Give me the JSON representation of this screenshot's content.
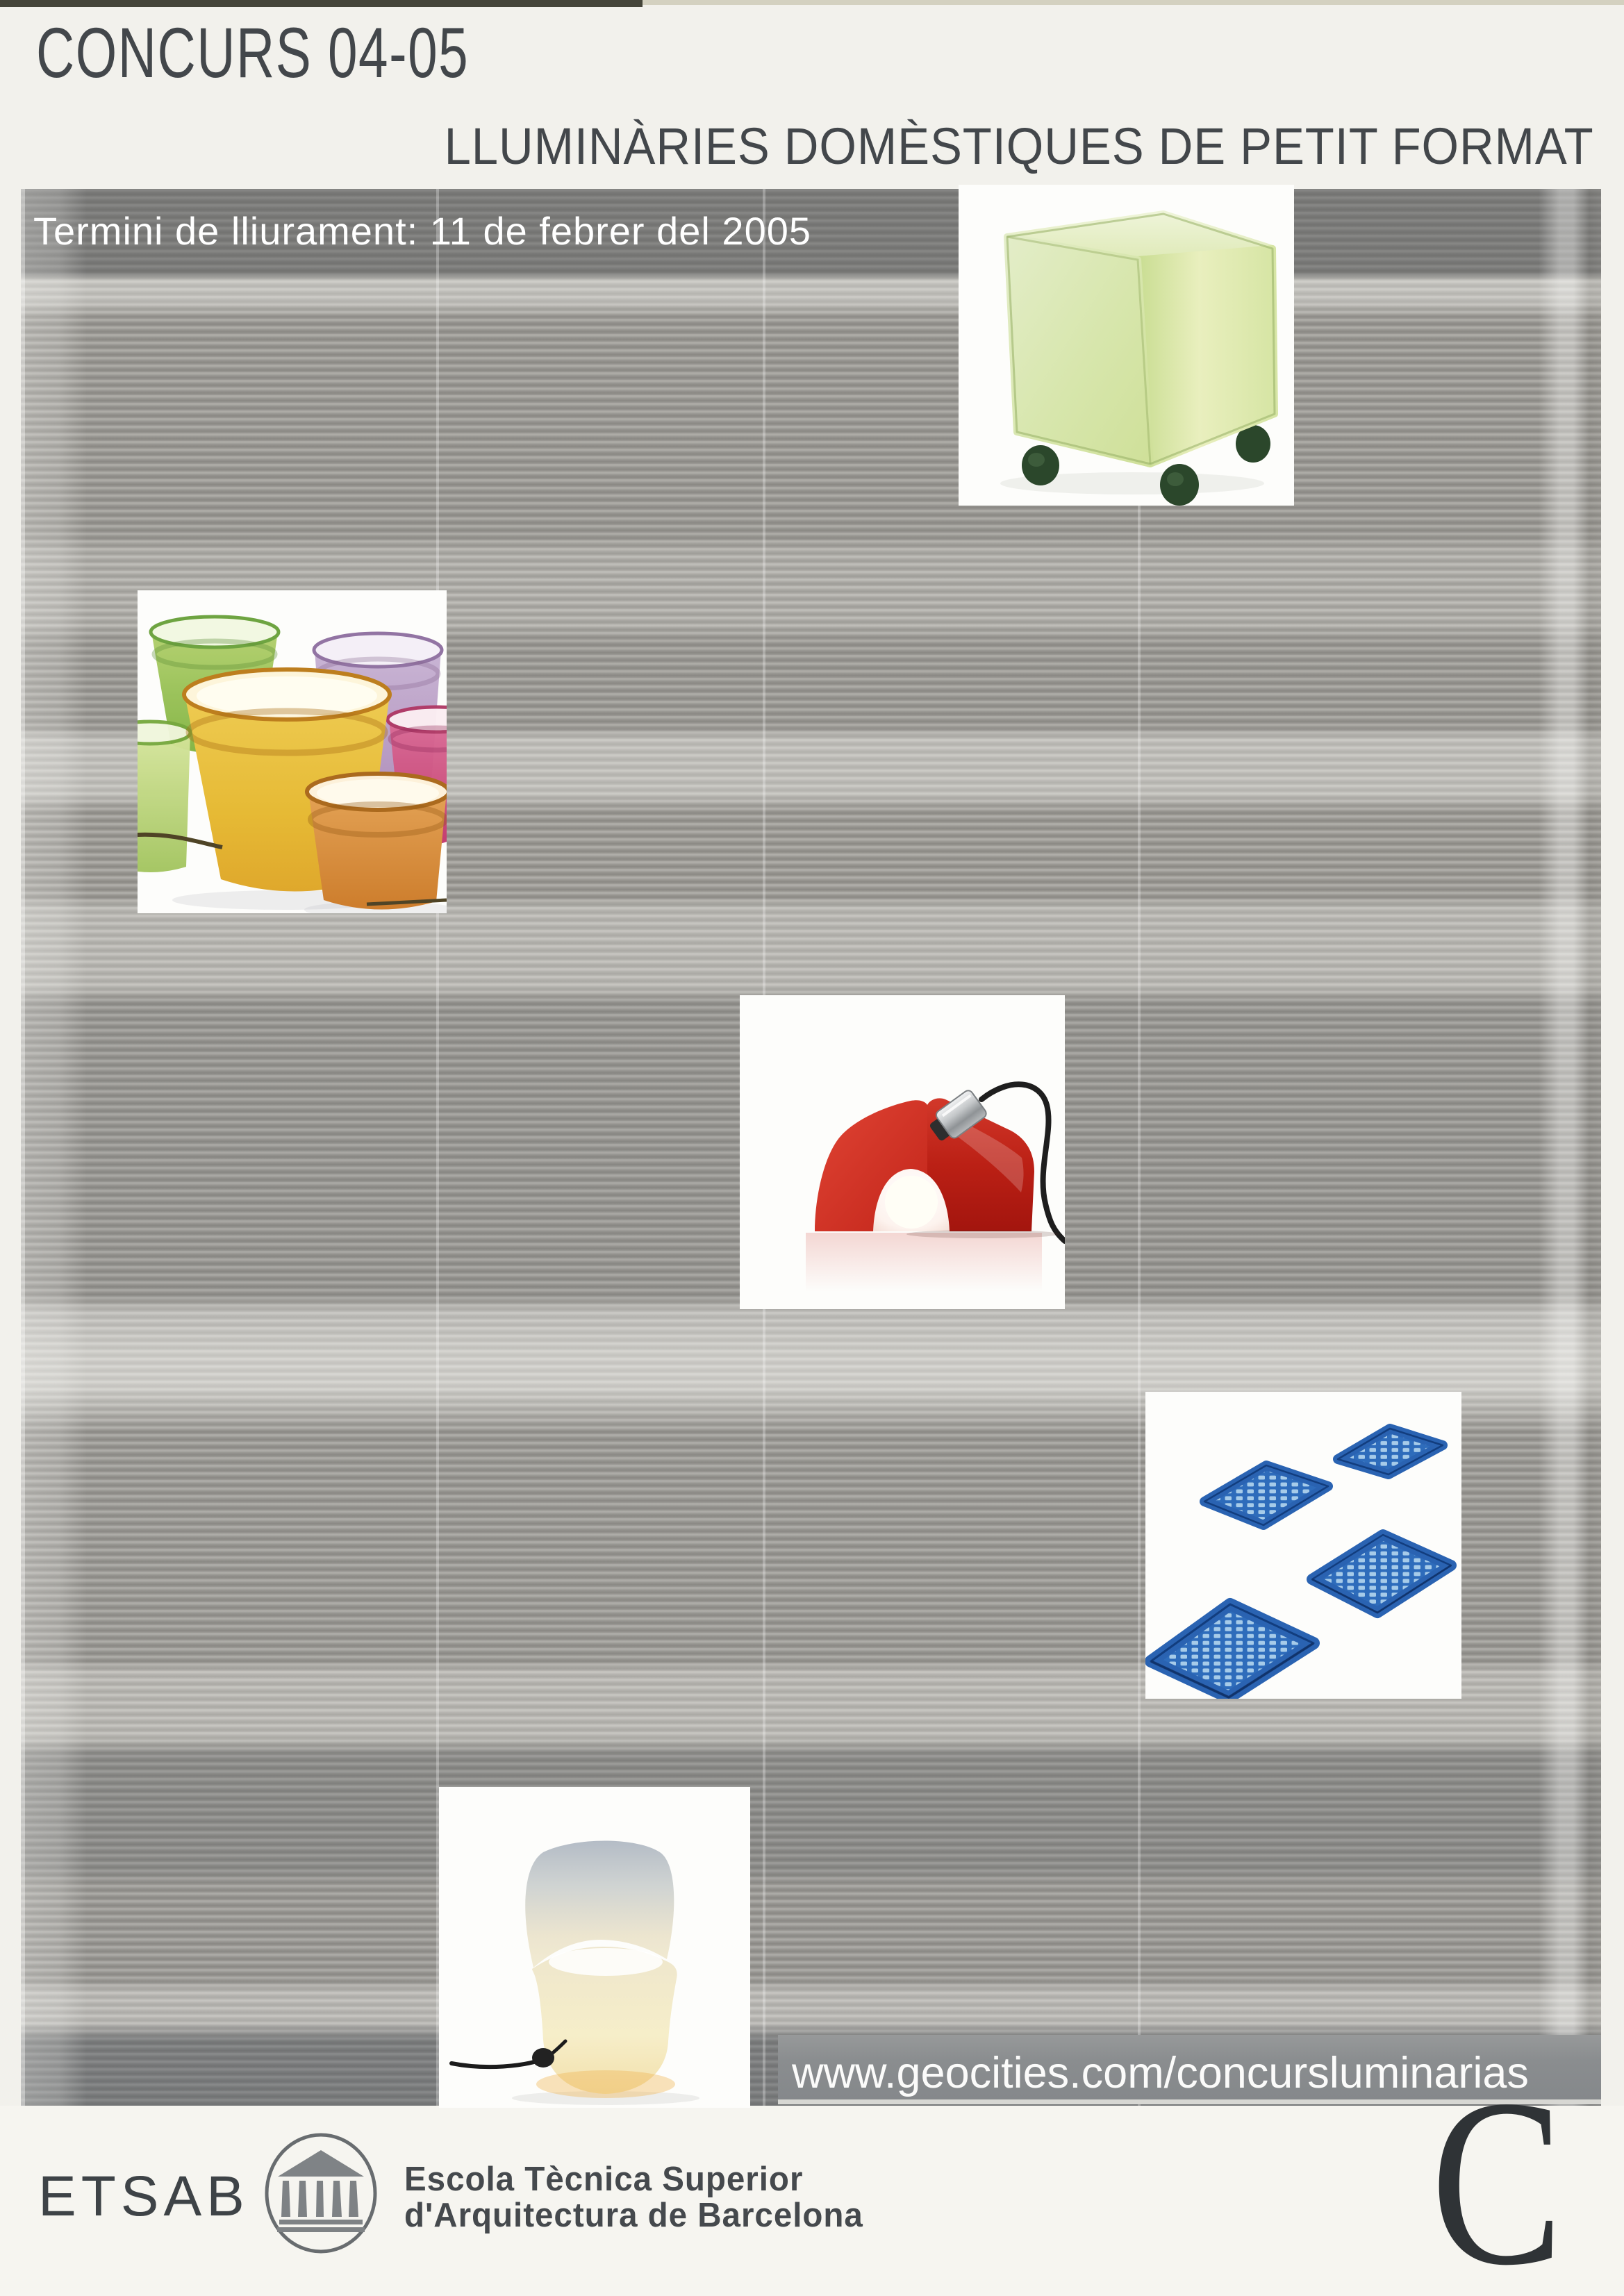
{
  "header": {
    "title": "CONCURS 04-05",
    "subtitle": "LLUMINÀRIES DOMÈSTIQUES DE PETIT FORMAT",
    "deadline": "Termini de lliurament: 11 de febrer del 2005"
  },
  "link": {
    "url": "www.geocities.com/concursluminarias"
  },
  "footer": {
    "school_acronym": "ETSAB",
    "school_name_line1": "Escola Tècnica Superior",
    "school_name_line2": "d'Arquitectura de Barcelona",
    "corner_letter": "C"
  },
  "images": {
    "cube_lamp": "green-cube-lamp-on-casters",
    "pot_lamps": "colored-flowerpot-lamps",
    "house_lamp": "red-house-shaped-lamp",
    "mat_lamps": "blue-grid-mat-lamps",
    "chair_lamp": "glowing-chair-lamp"
  },
  "colors": {
    "title_text": "#43474b",
    "deadline_text": "#ffffff",
    "blind_light": "#b6b4af",
    "blind_dark": "#8d8b86",
    "url_band": "#8a8d8f",
    "footer_text": "#45494d",
    "cube_green": "#d7e6ac",
    "pot_yellow": "#e6bd3d",
    "house_red": "#c3271b",
    "mat_blue": "#2e6cbb",
    "chair_cream": "#f2ebd2"
  }
}
